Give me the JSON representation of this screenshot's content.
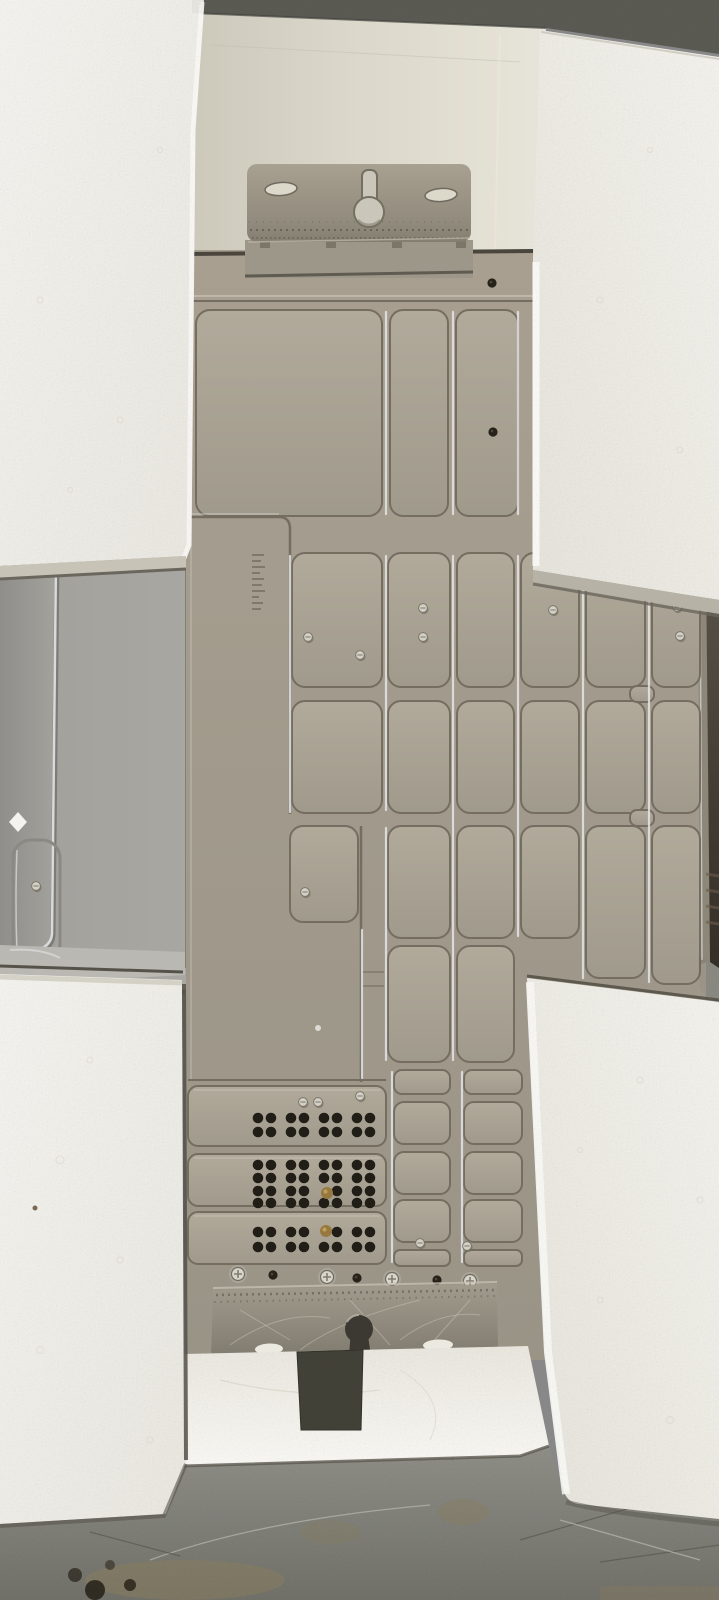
{
  "scene": {
    "type": "photograph",
    "subject": "appliance-back-panel-in-foam-packaging",
    "setting": "concrete-floor-top-down-view",
    "objects": [
      "styrofoam-block-top-left",
      "styrofoam-block-top-right",
      "styrofoam-block-bottom-left",
      "styrofoam-block-bottom-right",
      "sheet-metal-back-panel",
      "embossed-stiffening-pillows",
      "wall-mount-bracket-top",
      "wall-mount-bracket-bottom",
      "keyhole-slots",
      "oval-mounting-slots",
      "ventilation-hole-bands",
      "phillips-screws",
      "brass-screws",
      "side-panel-left",
      "concrete-floor"
    ]
  },
  "colors": {
    "panel": "#a29b8d",
    "pillowLight": "#b1aa9b",
    "pillowDark": "#a09a8c",
    "grooveDark": "#756e60",
    "grooveBright": "#e7eaec",
    "foam": "#f2f1ec",
    "foamShadow": "#d9d6cc",
    "foamLip": "#c7c3b6",
    "creamLeft": "#ccc8ba",
    "creamRight": "#e7e4d9",
    "stripDark": "#5c5c55",
    "floorLight": "#91918a",
    "floorDark": "#73736c",
    "floorScratch": "#b6b6ad",
    "floorStain": "#8b7f5e",
    "sidewall": "#a3a29d",
    "sidewallBright": "#d8dadb",
    "bracketLight": "#a8a090",
    "bracketDark": "#847e70",
    "keyhole": "#3b3932",
    "hatchHole": "#434238",
    "ventHole": "#211e17",
    "brass": "#97793f",
    "screwSilver": "#d8d5cd",
    "darkSide": "#352f27"
  }
}
